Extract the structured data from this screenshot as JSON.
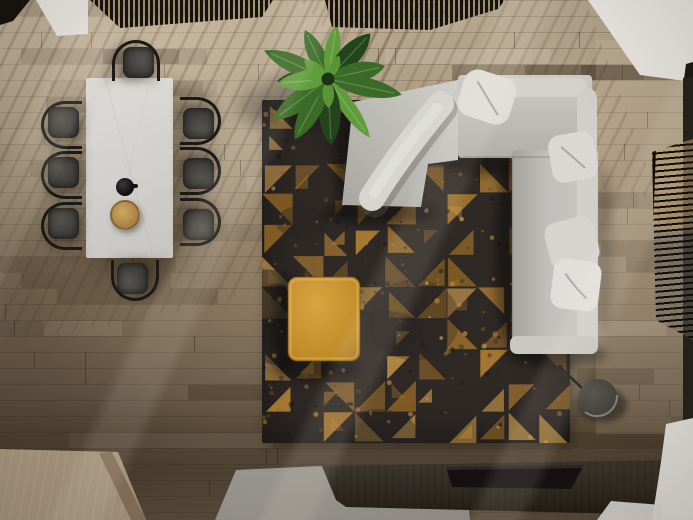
{
  "scene": {
    "description": "Top-down 3D render of a living room: light wood plank floor with diagonal slat shadows; white marble dining table with eight dark armchairs, a black teapot and a wooden bowl; a banana plant; a charcoal area rug with distressed amber triangle pattern; a light gray L-shaped sectional sofa with throw pillows; a mustard ottoman; a dark drum floor lamp; a dark wood media console with a black tray sitting over a gray stone slab; a light wood bench block at lower left; dark slatted screens along the top edge and a slatted window screen with white cabinetry on the right.",
    "objects": [
      {
        "label": "dining table"
      },
      {
        "label": "dining chairs"
      },
      {
        "label": "teapot"
      },
      {
        "label": "serving bowl"
      },
      {
        "label": "banana plant"
      },
      {
        "label": "area rug"
      },
      {
        "label": "ottoman"
      },
      {
        "label": "sectional sofa"
      },
      {
        "label": "throw pillows"
      },
      {
        "label": "floor lamp"
      },
      {
        "label": "media console"
      },
      {
        "label": "media tray"
      },
      {
        "label": "stone slab"
      },
      {
        "label": "wood bench block"
      },
      {
        "label": "slatted ceiling screens"
      },
      {
        "label": "window screen"
      },
      {
        "label": "white cabinets"
      }
    ]
  },
  "palette": {
    "floor_top": "#b7a78f",
    "floor_mid": "#96846c",
    "floor_low": "#6e5f4d",
    "floor_dark": "#4f4233",
    "rug_base": "#2f2926",
    "rug_amber": "#c28a33",
    "rug_amber_light": "#d8a44e",
    "rug_amber_dark": "#9a6c24",
    "sofa_light": "#cfcec9",
    "sofa_mid": "#b4b3af",
    "sofa_dark": "#8f8e89",
    "pillow": "#deddd9",
    "table_top": "#d8d6d2",
    "chair_seat": "#3a3836",
    "chair_frame": "#1b1a18",
    "ottoman_top": "#d29d3c",
    "ottoman_edge": "#a87820",
    "plant_dark": "#24441b",
    "plant_mid": "#3a6b28",
    "plant_light": "#5f9c3b",
    "wood_box": "#b6a38b",
    "wood_box_side": "#8a7660",
    "stone": "#a5a29b",
    "console_top": "#3d362e",
    "console_front": "#292319",
    "tray": "#141110",
    "lamp_shade": "#47453f",
    "lamp_rim": "#9b9995",
    "screen_slat": "#15130e",
    "white_surface": "#f0eee9"
  }
}
